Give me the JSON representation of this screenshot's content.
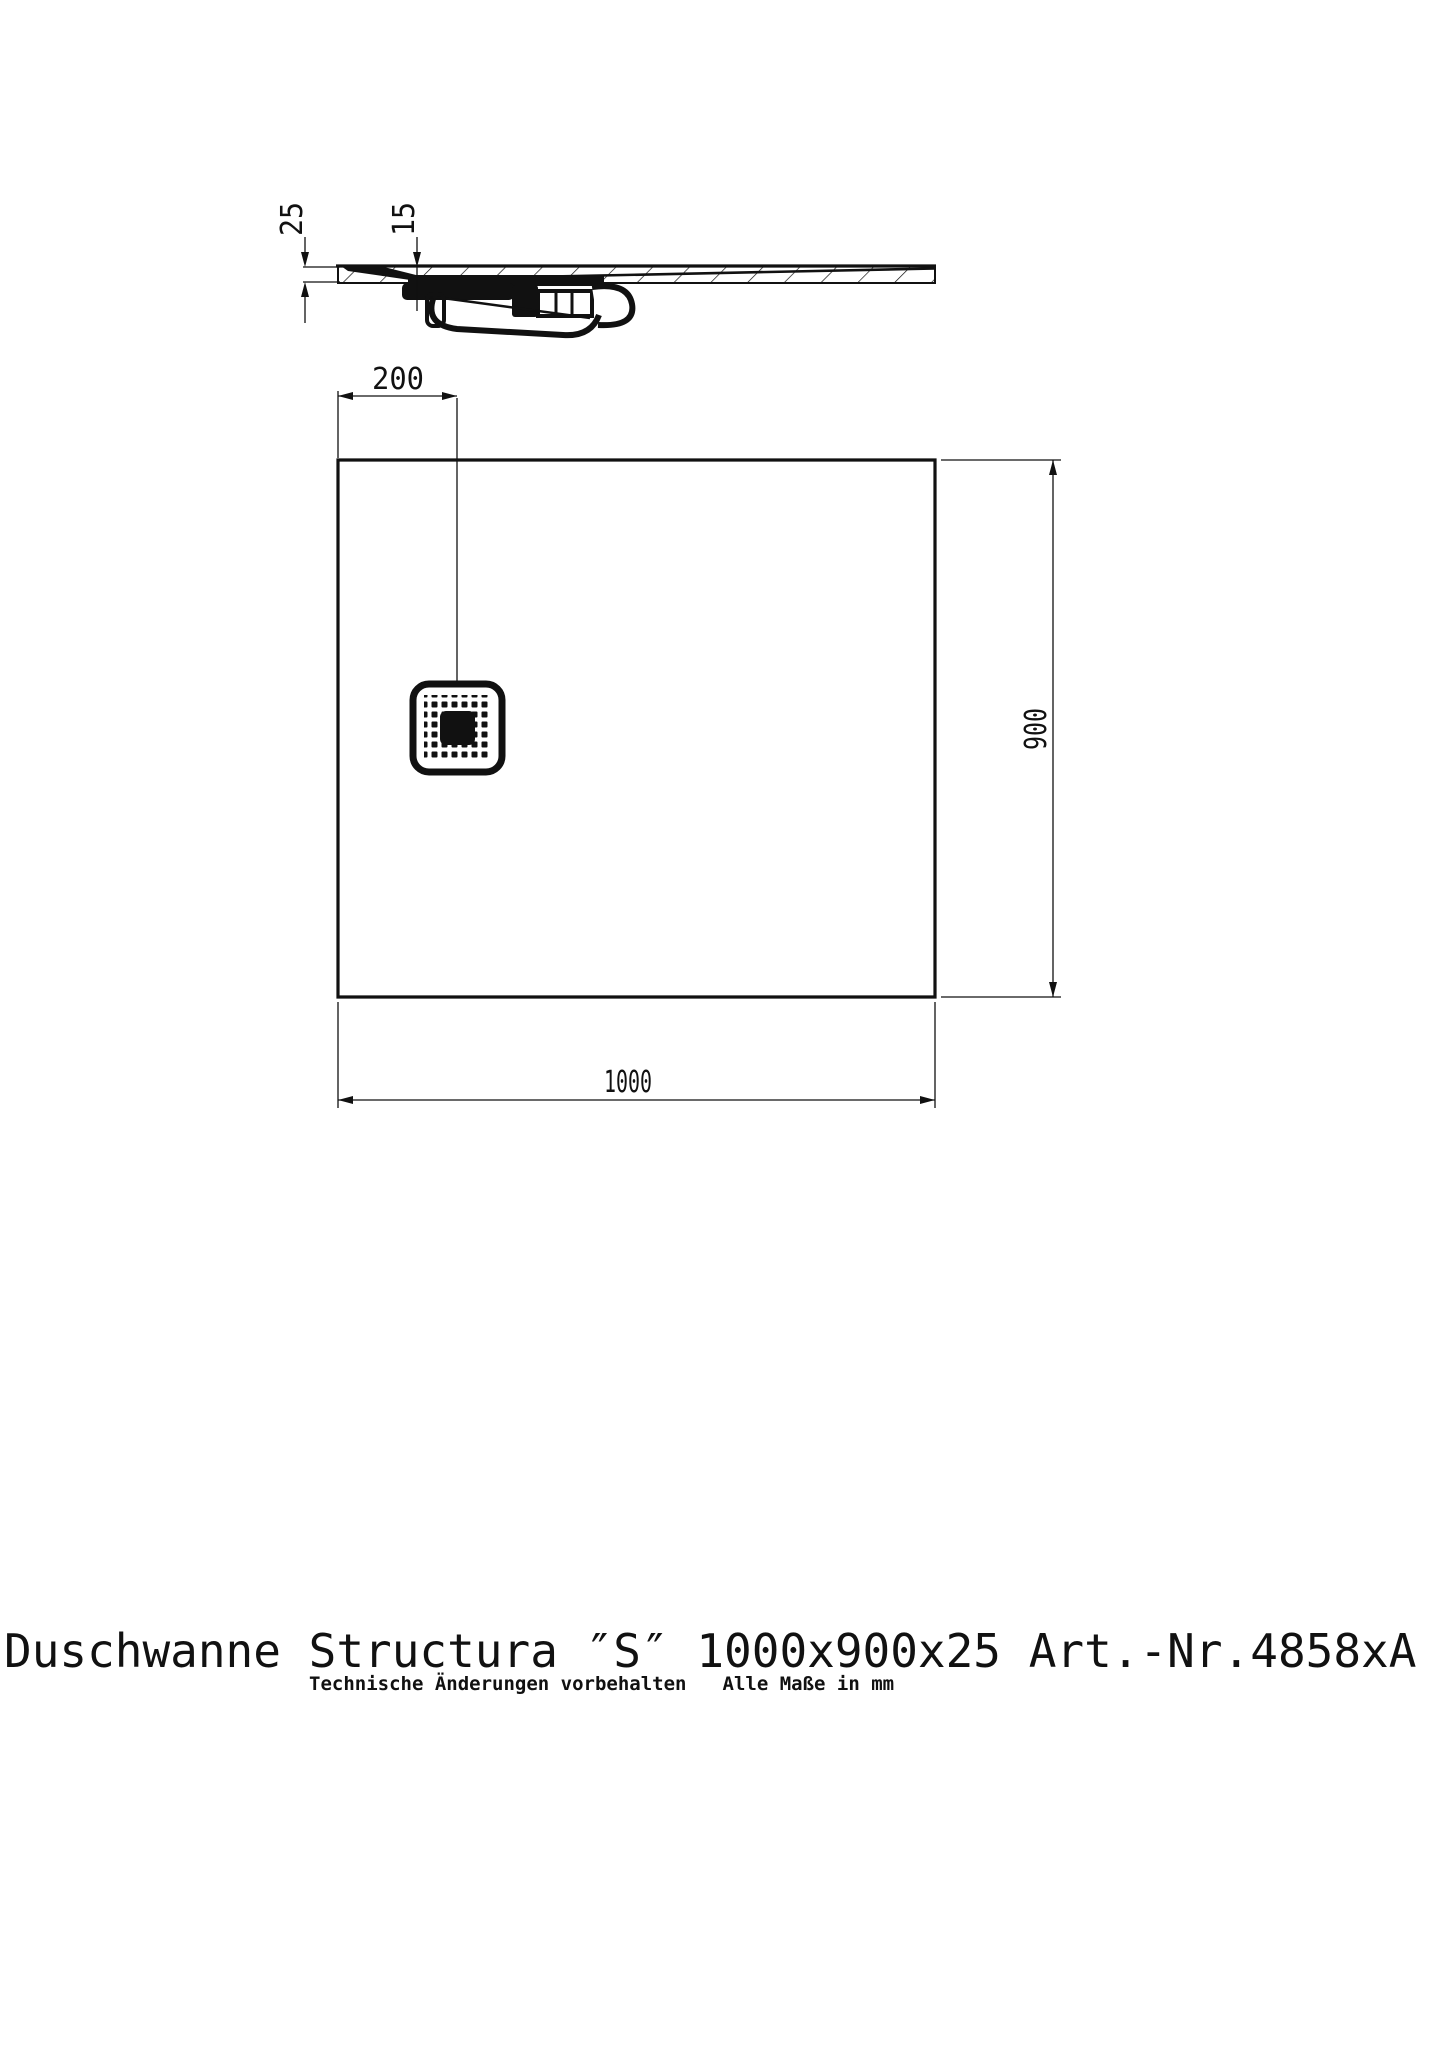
{
  "colors": {
    "paper": "#ffffff",
    "ink": "#111111"
  },
  "title": {
    "text": "Duschwanne Structura ″S″ 1000x900x25 Art.-Nr.4858xA"
  },
  "subtitle": {
    "note": "Technische Änderungen vorbehalten",
    "units": "Alle Maße in mm"
  },
  "views": {
    "section": {
      "dims": {
        "thickness": "25",
        "recess_depth": "15"
      }
    },
    "plan": {
      "dims": {
        "drain_offset": "200",
        "depth": "900",
        "width": "1000"
      }
    }
  }
}
